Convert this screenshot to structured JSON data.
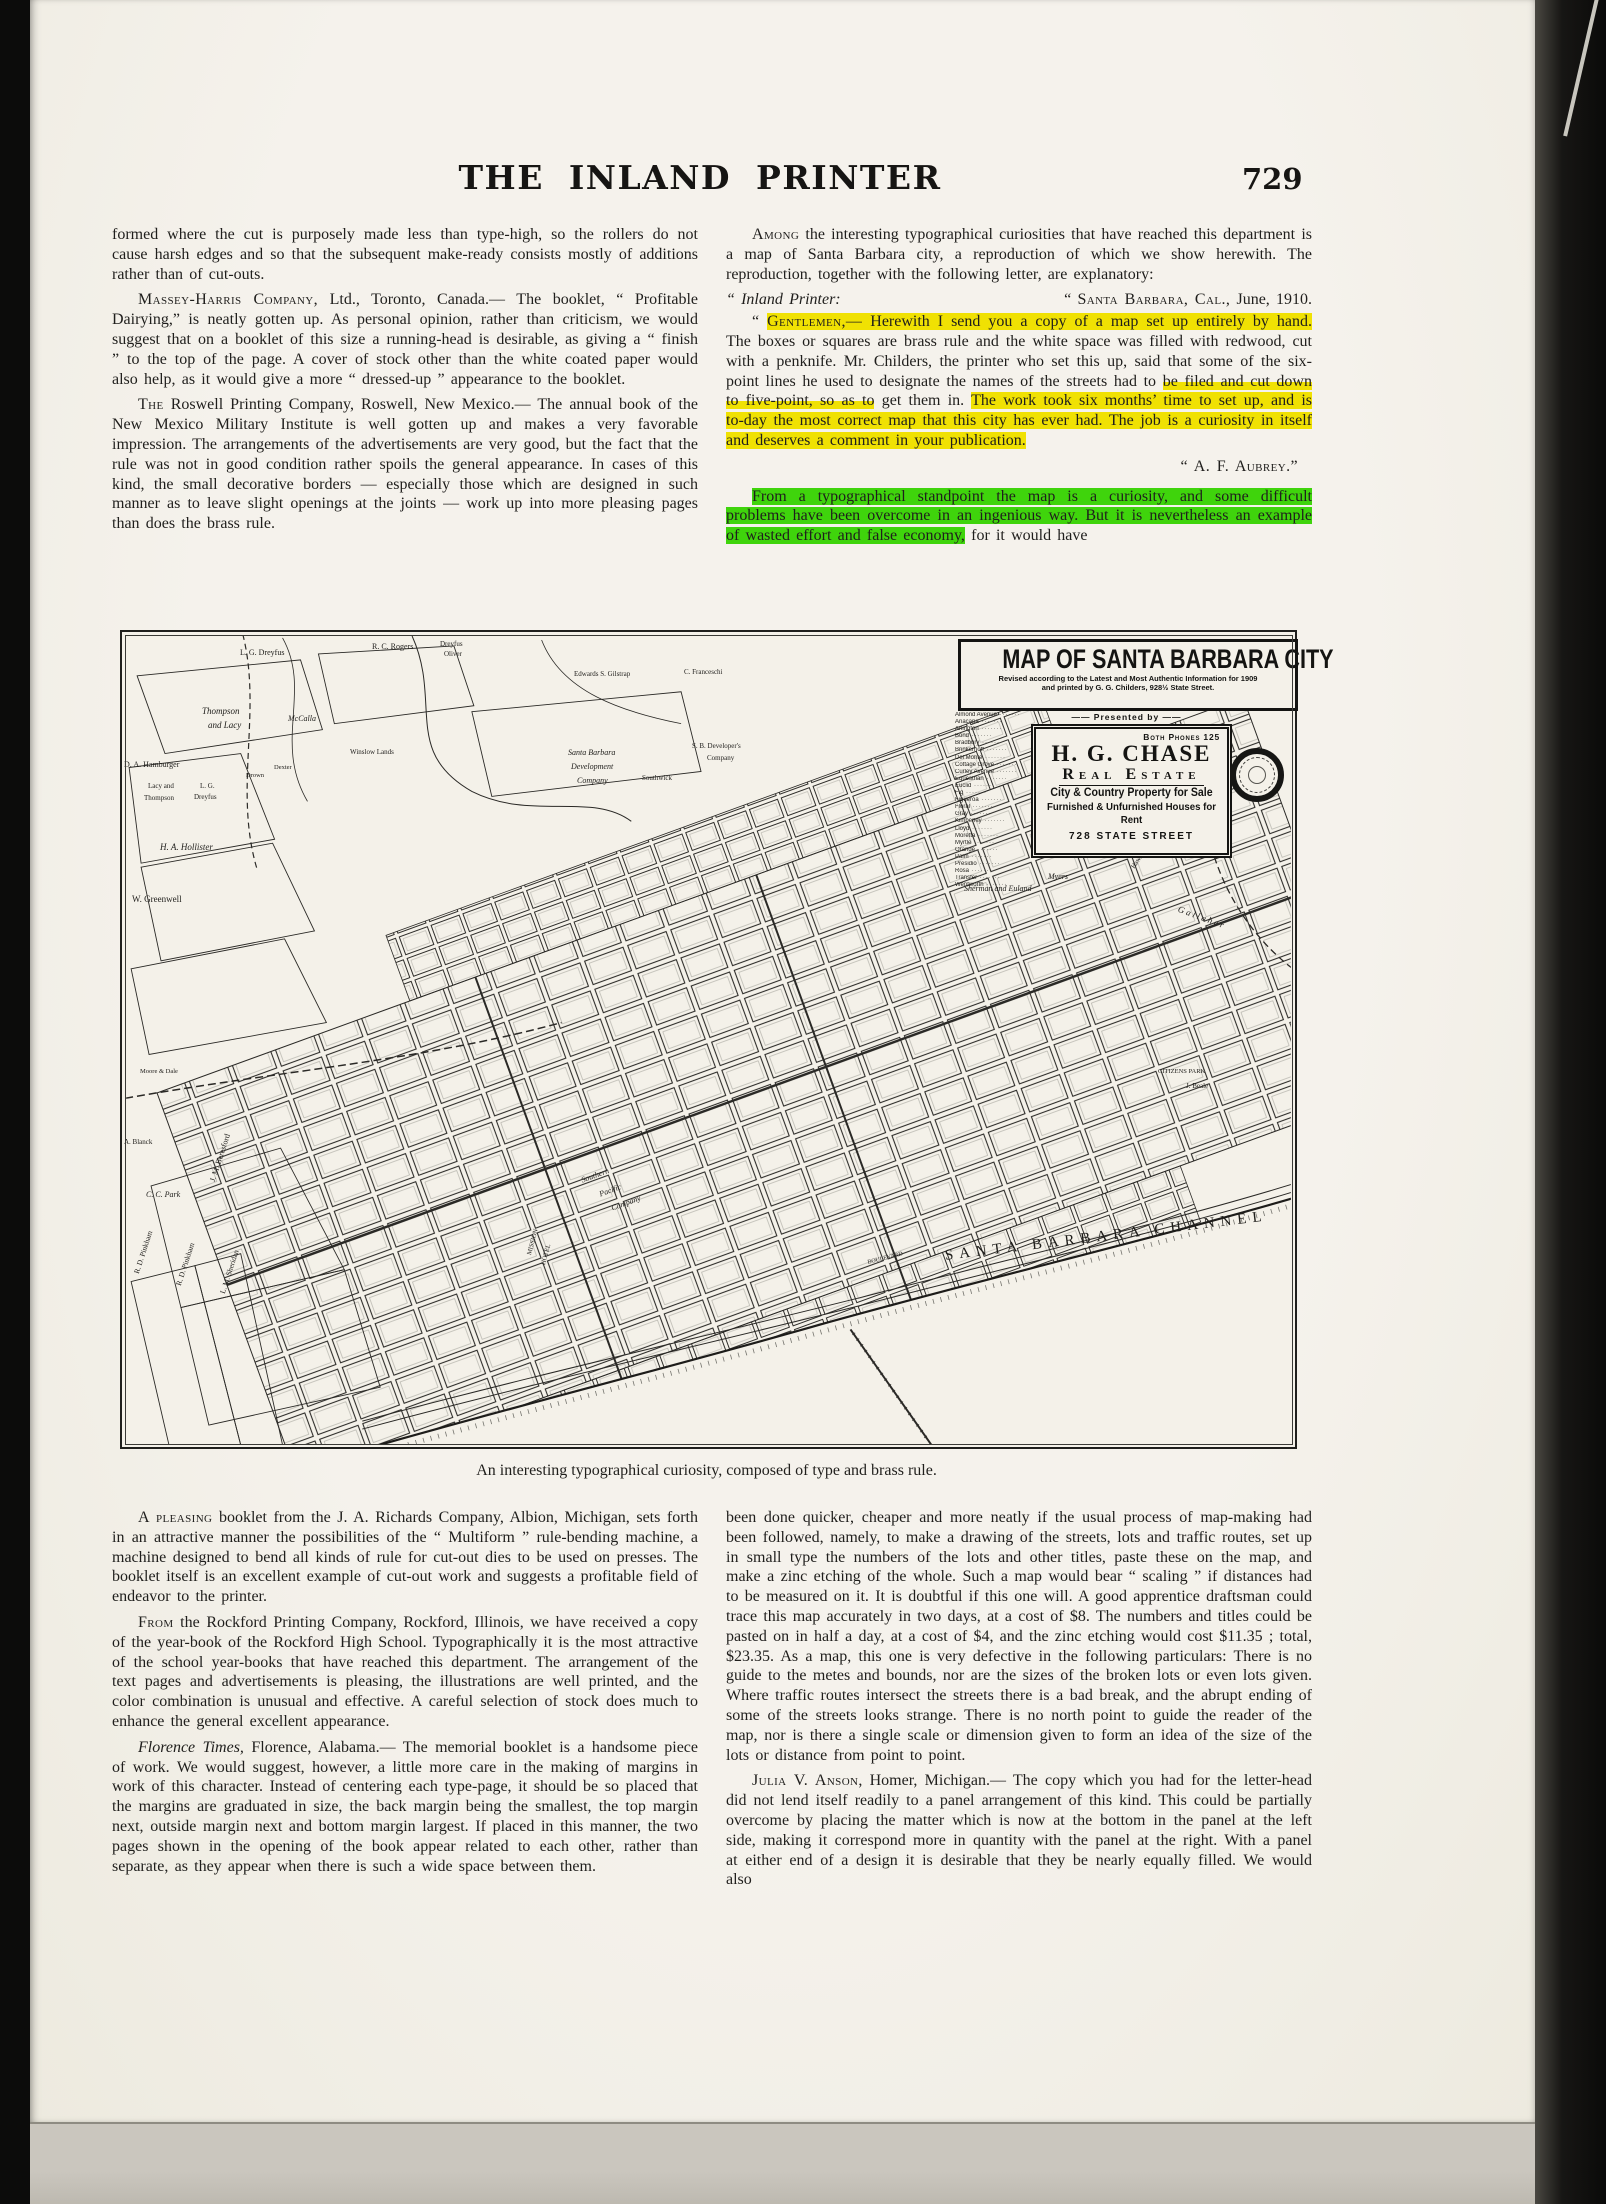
{
  "header": {
    "title": "THE INLAND PRINTER",
    "page_number": "729"
  },
  "tl": {
    "p1": "formed where the cut is purposely made less than type-high, so the rollers do not cause harsh edges and so that the subsequent make-ready consists mostly of additions rather than of cut-outs.",
    "p2_lead": "Massey-Harris Company,",
    "p2_rest": " Ltd., Toronto, Canada.— The booklet, “ Profitable Dairying,” is neatly gotten up.  As personal opinion, rather than criticism, we would suggest that on a booklet of this size a running-head is desirable, as giving a “ finish ” to the top of the page.  A cover of stock other than the white coated paper would also help, as it would give a more “ dressed-up ” appearance to the booklet.",
    "p3_lead": "The",
    "p3_rest": " Roswell Printing Company, Roswell, New Mexico.— The annual book of the New Mexico Military Institute is well gotten up and makes a very favorable impression.  The arrangements of the advertisements are very good, but the fact that the rule was not in good condition rather spoils the general appearance.  In cases of this kind, the small decorative borders — especially those which are designed in such manner as to leave slight openings at the joints — work up into more pleasing pages than does the brass rule."
  },
  "tr": {
    "p1_lead": "Among",
    "p1_rest": " the interesting typographical curiosities that have reached this department is a map of Santa Barbara city, a reproduction of which we show herewith.  The reproduction, together with the following letter, are explanatory:",
    "lh_left": "“ Inland Printer:",
    "lh_right_q": "“ ",
    "lh_right_sc": "Santa Barbara, Cal.,",
    "lh_right_rest": " June, 1910.",
    "letter_s0": "“ ",
    "letter_s1": "Gentlemen,—",
    "letter_s2": " Herewith I send you a copy of a map set up entirely by hand.",
    "letter_s3": "  The boxes or squares are brass rule and the white space was filled with redwood, cut with a penknife.  Mr. Childers, the printer who set this up, said that some of the six-point lines he used to designate the names of the streets had to ",
    "letter_s4": "be filed and cut down to five-point, so as to",
    "letter_s5": " get them in.  ",
    "letter_s6": "The work took six months’ time to set up, and is to-day the most correct map that this city has ever had.  The job is a curiosity in itself and deserves a comment in your publication.",
    "letter_sig": "“ A. F. Aubrey.”",
    "g1": "From a typographical standpoint the map is a curiosity, and some difficult problems have been overcome in an ingenious way.  But it is nevertheless an example of wasted effort and false economy,",
    "g2": " for it would have"
  },
  "figure": {
    "caption": "An interesting typographical curiosity, composed of type and brass rule."
  },
  "map": {
    "title": "MAP OF SANTA BARBARA CITY",
    "subtitle1": "Revised according to the Latest and Most Authentic Information for 1909",
    "subtitle2": "and printed by G. G. Childers, 928½ State Street.",
    "presented_by": "—— Presented by ——",
    "ad": {
      "phones": "Both Phones 125",
      "name": "H. G. CHASE",
      "business": "Real Estate",
      "line1": "City & Country Property for Sale",
      "line2": "Furnished & Unfurnished Houses for Rent",
      "address": "728 STATE STREET"
    },
    "street_index": [
      "Almond Avenue",
      "Anacapa",
      "Arlington",
      "Bond",
      "Bradbury",
      "Brinkerhoff",
      "Del Monte",
      "Cottage Grove",
      "Curley Avenue",
      "Equestrian",
      "Euclid",
      "Fig",
      "Figueroa",
      "Floral",
      "Gray",
      "Kimberley",
      "Lloyd",
      "Moretta",
      "Myrtle",
      "Orange",
      "Palm",
      "Presidio",
      "Rosa",
      "Transfer",
      "Wentworth"
    ],
    "channel": "SANTA BARBARA CHANNEL",
    "labels": [
      {
        "t": "L. G. Dreyfus",
        "x": 118,
        "y": 16,
        "s": 8
      },
      {
        "t": "R. C. Rogers",
        "x": 250,
        "y": 10,
        "s": 8
      },
      {
        "t": "Dreyfus",
        "x": 318,
        "y": 8,
        "s": 7
      },
      {
        "t": "Oliver",
        "x": 322,
        "y": 18,
        "s": 7
      },
      {
        "t": "Edwards S. Gilstrap",
        "x": 452,
        "y": 38,
        "s": 7
      },
      {
        "t": "C. Franceschi",
        "x": 562,
        "y": 36,
        "s": 7
      },
      {
        "t": "Thompson",
        "x": 80,
        "y": 74,
        "s": 9,
        "it": 1
      },
      {
        "t": "and Lacy",
        "x": 86,
        "y": 88,
        "s": 9,
        "it": 1
      },
      {
        "t": "McCalla",
        "x": 166,
        "y": 82,
        "s": 8,
        "it": 1
      },
      {
        "t": "Winslow Lands",
        "x": 228,
        "y": 116,
        "s": 7
      },
      {
        "t": "Santa Barbara",
        "x": 446,
        "y": 116,
        "s": 8,
        "it": 1
      },
      {
        "t": "Development",
        "x": 449,
        "y": 130,
        "s": 8,
        "it": 1
      },
      {
        "t": "Company",
        "x": 455,
        "y": 144,
        "s": 8,
        "it": 1
      },
      {
        "t": "Southwick",
        "x": 520,
        "y": 142,
        "s": 7
      },
      {
        "t": "S. B. Developer's",
        "x": 570,
        "y": 110,
        "s": 7
      },
      {
        "t": "Company",
        "x": 585,
        "y": 122,
        "s": 7
      },
      {
        "t": "D. A. Hamburger",
        "x": 2,
        "y": 128,
        "s": 8
      },
      {
        "t": "Lacy and",
        "x": 26,
        "y": 150,
        "s": 7
      },
      {
        "t": "Thompson",
        "x": 22,
        "y": 162,
        "s": 7
      },
      {
        "t": "L. G.",
        "x": 78,
        "y": 150,
        "s": 7
      },
      {
        "t": "Dreyfus",
        "x": 72,
        "y": 161,
        "s": 7
      },
      {
        "t": "Drown",
        "x": 124,
        "y": 140,
        "s": 6.5
      },
      {
        "t": "Dexter",
        "x": 152,
        "y": 132,
        "s": 6.5
      },
      {
        "t": "H. A. Hollister",
        "x": 38,
        "y": 210,
        "s": 9,
        "it": 1
      },
      {
        "t": "W. Greenwell",
        "x": 10,
        "y": 262,
        "s": 9
      },
      {
        "t": "Moore & Dale",
        "x": 18,
        "y": 436,
        "s": 6.5
      },
      {
        "t": "Sherman and Euland",
        "x": 842,
        "y": 252,
        "s": 8,
        "it": 1
      },
      {
        "t": "Myers",
        "x": 926,
        "y": 240,
        "s": 8,
        "it": 1
      },
      {
        "t": "Hawthorne",
        "x": 1008,
        "y": 234,
        "s": 6.5,
        "r": -55
      },
      {
        "t": "G a l l a h e r",
        "x": 1058,
        "y": 272,
        "s": 9,
        "r": 20,
        "it": 1
      },
      {
        "t": "CITIZENS PARK",
        "x": 1036,
        "y": 436,
        "s": 6.5
      },
      {
        "t": "J. Beale",
        "x": 1064,
        "y": 450,
        "s": 7
      },
      {
        "t": "Southern",
        "x": 458,
        "y": 544,
        "s": 8,
        "it": 1,
        "r": -20
      },
      {
        "t": "Pacific",
        "x": 476,
        "y": 558,
        "s": 8,
        "it": 1,
        "r": -20
      },
      {
        "t": "Company",
        "x": 488,
        "y": 572,
        "s": 8,
        "it": 1,
        "r": -20
      },
      {
        "t": "MISSION",
        "x": 404,
        "y": 622,
        "s": 6.5,
        "r": -75
      },
      {
        "t": "HOTEL",
        "x": 418,
        "y": 632,
        "s": 6.5,
        "r": -75
      },
      {
        "t": "BOULEVARD",
        "x": 745,
        "y": 628,
        "s": 6,
        "r": -14
      },
      {
        "t": "C. C. Park",
        "x": 24,
        "y": 558,
        "s": 8,
        "it": 1
      },
      {
        "t": "J. M. Beresford",
        "x": 86,
        "y": 548,
        "s": 8,
        "r": -72
      },
      {
        "t": "A. Blanck",
        "x": 2,
        "y": 506,
        "s": 7
      },
      {
        "t": "R. D. Pinkham",
        "x": 10,
        "y": 640,
        "s": 7.5,
        "r": -72
      },
      {
        "t": "R. D. Pinkham",
        "x": 52,
        "y": 652,
        "s": 7.5,
        "r": -72
      },
      {
        "t": "L. M. Sheridan",
        "x": 96,
        "y": 660,
        "s": 7.5,
        "r": -72
      }
    ]
  },
  "bl": {
    "p1_lead": "A pleasing",
    "p1_rest": " booklet from the J. A. Richards Company, Albion, Michigan, sets forth in an attractive manner the possibilities of the “ Multiform ” rule-bending machine, a machine designed to bend all kinds of rule for cut-out dies to be used on presses.  The booklet itself is an excellent example of cut-out work and suggests a profitable field of endeavor to the printer.",
    "p2_lead": "From",
    "p2_rest": " the Rockford Printing Company, Rockford, Illinois, we have received a copy of the year-book of the Rockford High School.  Typographically it is the most attractive of the school year-books that have reached this department.  The arrangement of the text pages and advertisements is pleasing, the illustrations are well printed, and the color combination is unusual and effective.  A careful selection of stock does much to enhance the general excellent appearance.",
    "p3_lead": "Florence Times,",
    "p3_rest": " Florence, Alabama.— The memorial booklet is a handsome piece of work.  We would suggest, however, a little more care in the making of margins in work of this character.  Instead of centering each type-page, it should be so placed that the margins are graduated in size, the back margin being the smallest, the top margin next, outside margin next and bottom margin largest.  If placed in this manner, the two pages shown in the opening of the book appear related to each other, rather than separate, as they appear when there is such a wide space between them."
  },
  "br": {
    "p1": "been done quicker, cheaper and more neatly if the usual process of map-making had been followed, namely, to make a drawing of the streets, lots and traffic routes, set up in small type the numbers of the lots and other titles, paste these on the map, and make a zinc etching of the whole.  Such a map would bear “ scaling ” if distances had to be measured on it.  It is doubtful if this one will.  A good apprentice draftsman could trace this map accurately in two days, at a cost of $8.  The numbers and titles could be pasted on in half a day, at a cost of $4, and the zinc etching would cost $11.35 ;  total, $23.35.  As a map, this one is very defective in the following particulars:  There is no guide to the metes and bounds, nor are the sizes of the broken lots or even lots given.  Where traffic routes intersect the streets there is a bad break, and the abrupt ending of some of the streets looks strange.  There is no north point to guide the reader of the map, nor is there a single scale or dimension given to form an idea of the size of the lots or distance from point to point.",
    "p2_lead": "Julia V. Anson",
    "p2_rest": ", Homer, Michigan.— The copy which you had for the letter-head did not lend itself readily to a panel arrangement of this kind.  This could be partially overcome by placing the matter which is now at the bottom in the panel at the left side, making it correspond more in quantity with the panel at the right.  With a panel at either end of a design it is desirable that they be nearly equally filled.  We would also"
  }
}
